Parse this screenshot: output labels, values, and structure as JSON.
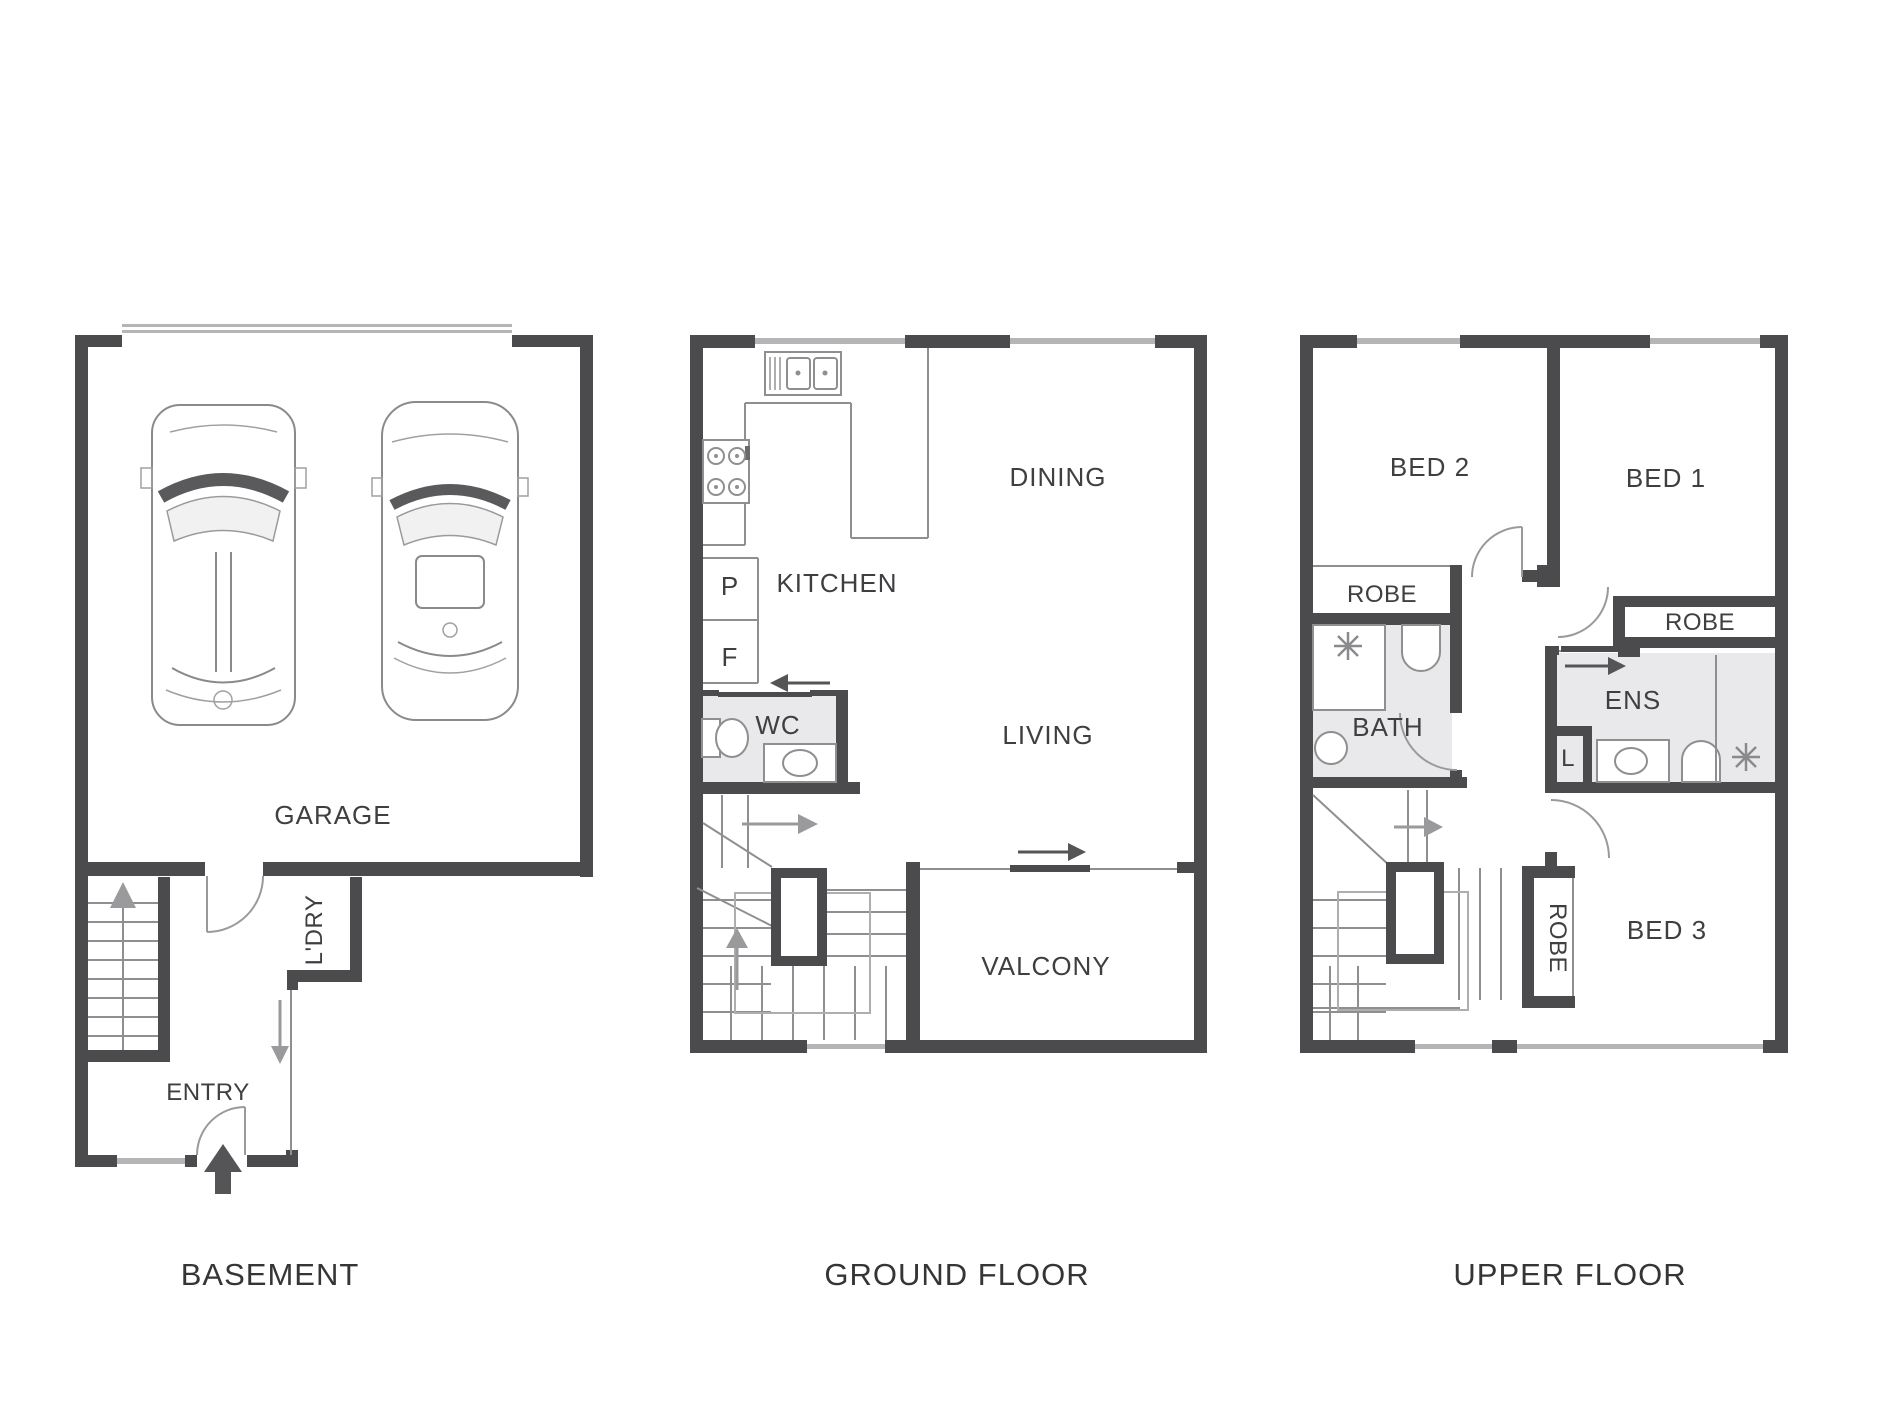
{
  "title": "Three level townhouse floor plan",
  "colors": {
    "wall": "#4b4b4d",
    "window": "#b5b5b7",
    "thin_line": "#8f8f91",
    "room_fill": "#e9e9ec",
    "text": "#3f3f41",
    "arrow_gray": "#9a9a9c",
    "arrow_dark": "#555557",
    "background": "#ffffff"
  },
  "floors": [
    {
      "caption": "BASEMENT",
      "labels": {
        "garage": "GARAGE",
        "laundry": "L'DRY",
        "entry": "ENTRY"
      }
    },
    {
      "caption": "GROUND FLOOR",
      "labels": {
        "pantry": "P",
        "fridge": "F",
        "kitchen": "KITCHEN",
        "dining": "DINING",
        "wc": "WC",
        "living": "LIVING",
        "balcony": "VALCONY"
      }
    },
    {
      "caption": "UPPER FLOOR",
      "labels": {
        "bed1": "BED 1",
        "bed2": "BED 2",
        "bed3": "BED 3",
        "robe_bed1": "ROBE",
        "robe_bed2": "ROBE",
        "robe_bed3": "ROBE",
        "bath": "BATH",
        "ens": "ENS",
        "linen": "L"
      }
    }
  ]
}
